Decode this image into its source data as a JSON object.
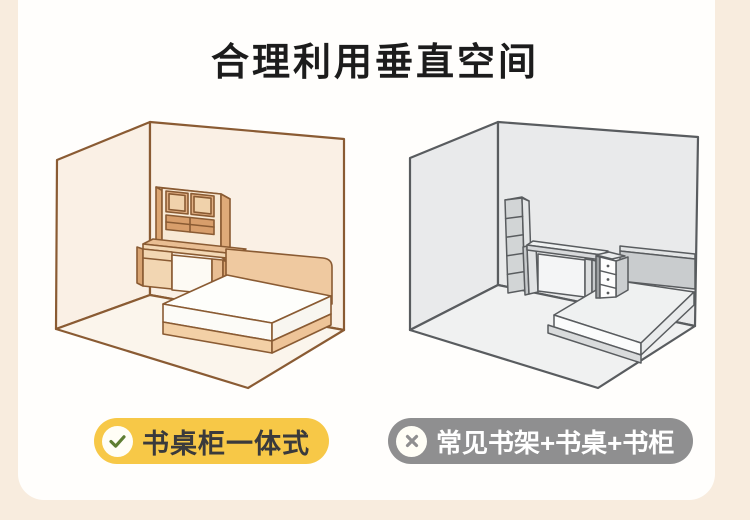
{
  "page": {
    "title": "合理利用垂直空间",
    "background_color": "#F8ECDE",
    "card_color": "#FFFEFC"
  },
  "comparison": {
    "left": {
      "label": "书桌柜一体式",
      "icon": "check-icon",
      "badge_color": "#F7C847",
      "icon_color": "#5E7E33",
      "text_color": "#3A3A3C",
      "line_color": "#8A5B33",
      "illustration": "bedroom with full-height integrated desk-cabinet unit and bed"
    },
    "right": {
      "label": "常见书架+书桌+书柜",
      "icon": "cross-icon",
      "badge_color": "#8F8F90",
      "icon_color": "#8F8F90",
      "text_color": "#FFFFFF",
      "line_color": "#55585A",
      "illustration": "bedroom with separate bookshelf, desk, drawer cabinet and bed"
    }
  }
}
